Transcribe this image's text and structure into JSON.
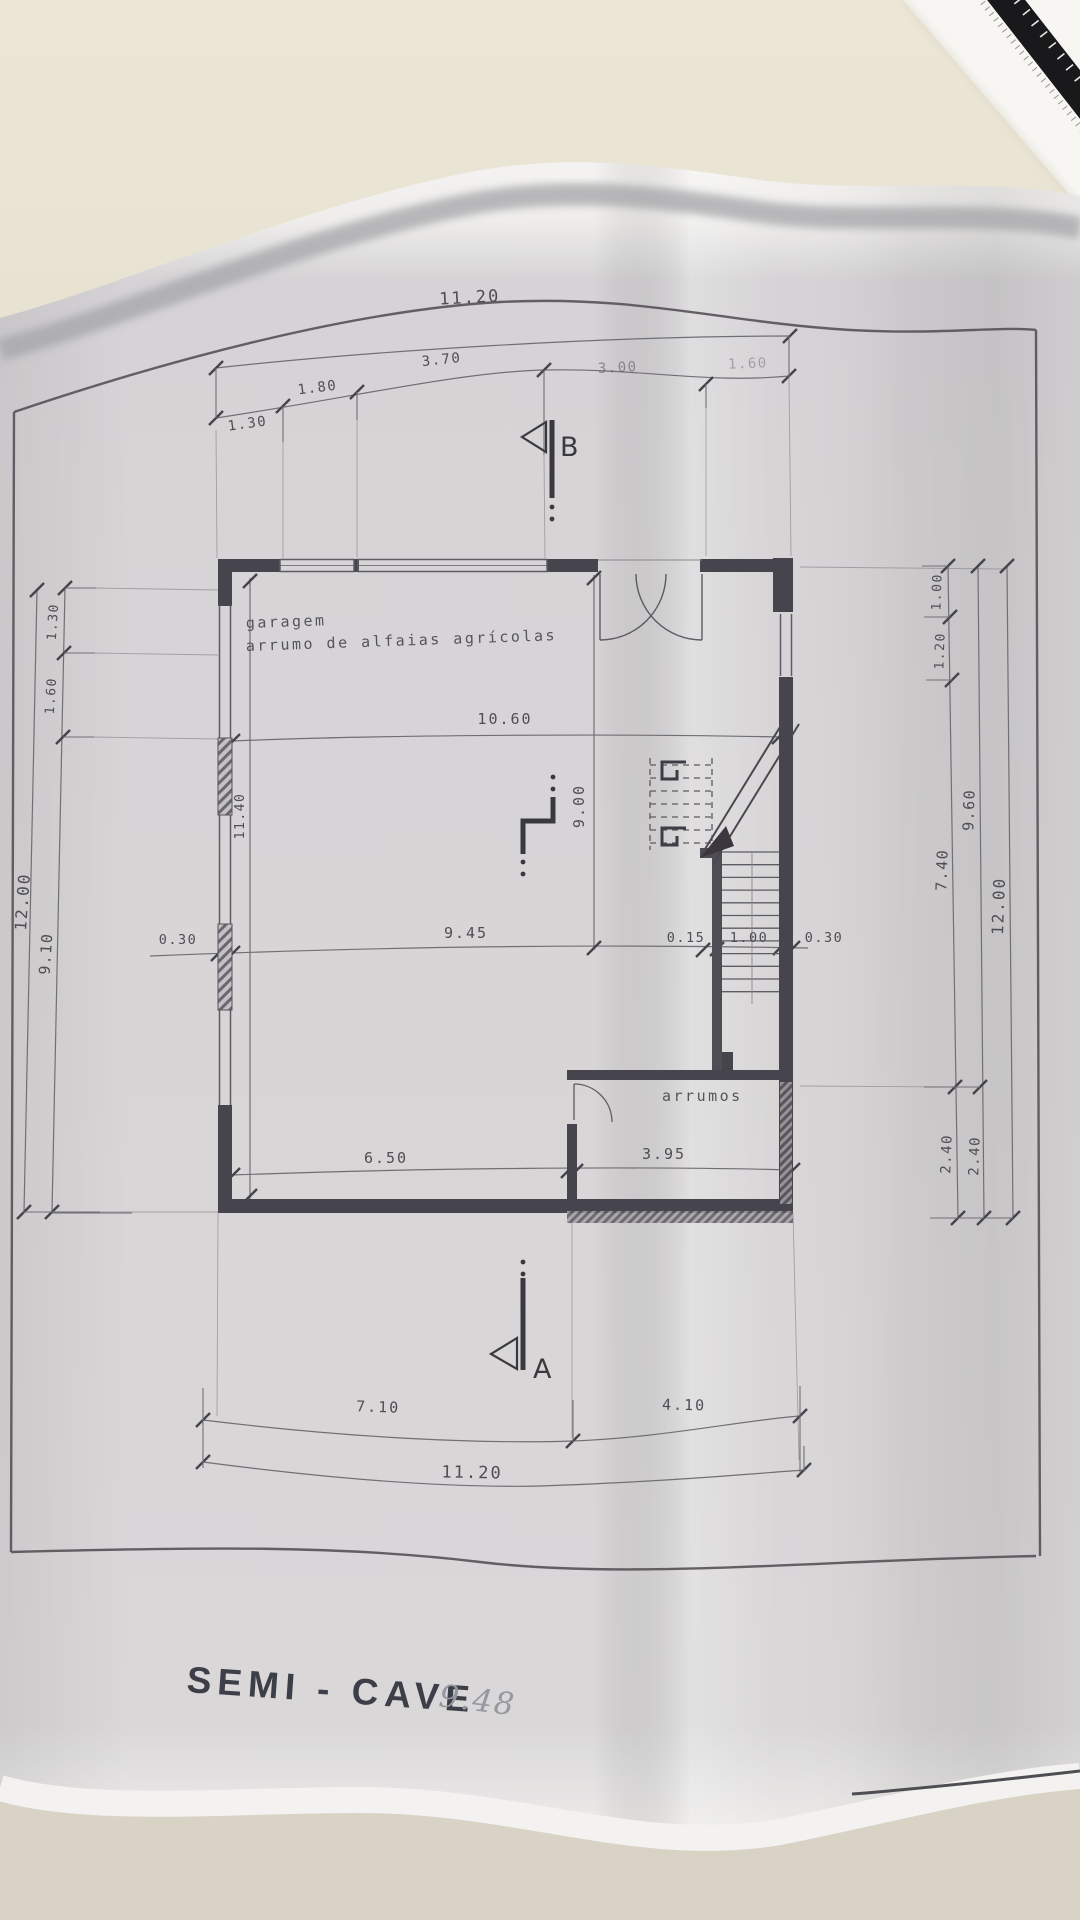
{
  "photo": {
    "title_block": {
      "title": "SEMI - CAVE",
      "handwritten_note": "9.48"
    },
    "rooms": {
      "garage_label_line1": "garagem",
      "garage_label_line2": "arrumo de alfaias agrícolas",
      "storage_label": "arrumos"
    },
    "section_markers": {
      "top": "B",
      "bottom": "A"
    },
    "dimensions": {
      "top_chain": {
        "total": "11.20",
        "segments": [
          "1.30",
          "1.80",
          "3.70",
          "3.00",
          "1.60"
        ]
      },
      "bottom_chain": {
        "total": "11.20",
        "segments": [
          "7.10",
          "4.10"
        ]
      },
      "left_chain": {
        "total": "12.00",
        "segments": [
          "1.30",
          "1.60",
          "9.10"
        ]
      },
      "right_chain": {
        "total": "12.00",
        "col_inner": [
          "1.00",
          "1.20",
          "7.40",
          "2.40"
        ],
        "col_middle": [
          "9.60",
          "2.40"
        ]
      },
      "interior": {
        "garage_width": "10.60",
        "garage_depth": "9.00",
        "left_wall_inner": "11.40",
        "mid_left_wall": "0.30",
        "mid_span": "9.45",
        "stair_wall": "0.15",
        "stair_width": "1.00",
        "mid_right_wall": "0.30",
        "storage_row_left": "6.50",
        "storage_row_right": "3.95"
      }
    },
    "colors": {
      "desk": "#e9e3d3",
      "paper": "#d6d4d5",
      "paper_edge": "#f4f3f1",
      "ink": "#4f4d55",
      "wall": "#46444c",
      "title_ink": "#3d3f48",
      "pencil": "#9698a0",
      "ruler": "#19181b"
    }
  }
}
